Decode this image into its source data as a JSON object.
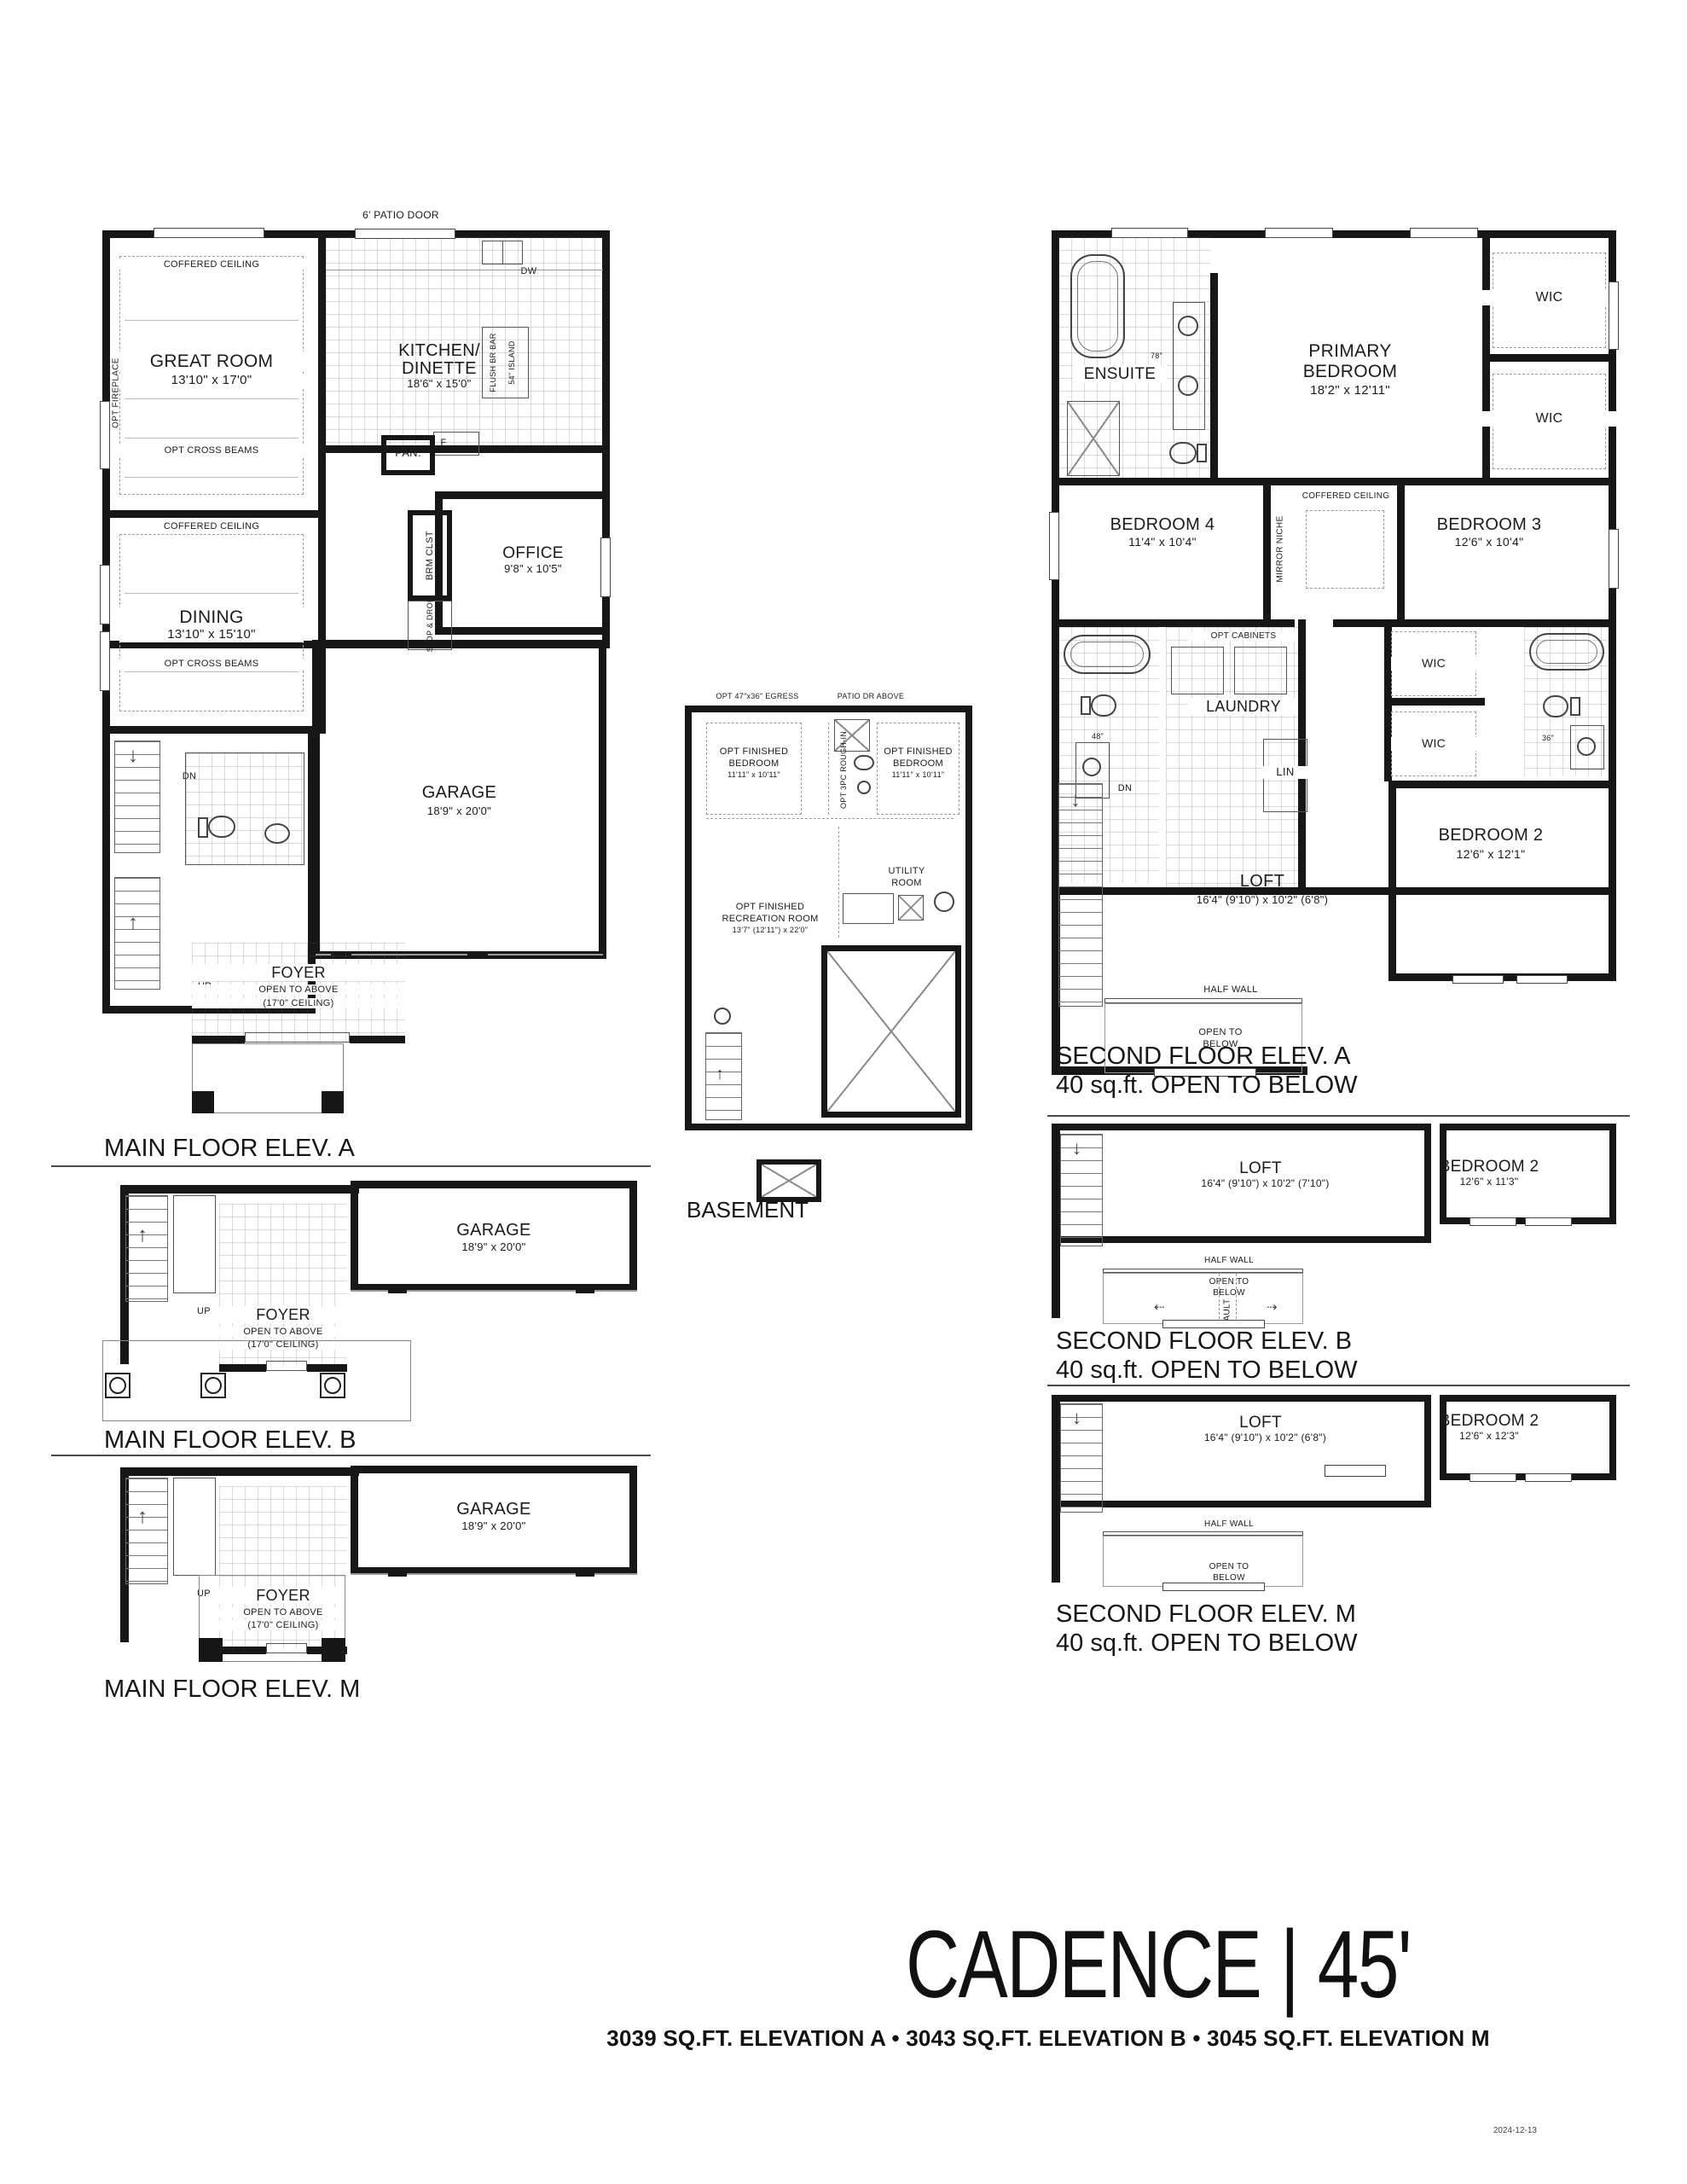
{
  "title": "CADENCE | 45'",
  "subtitle": "3039 SQ.FT. ELEVATION A • 3043 SQ.FT. ELEVATION B • 3045 SQ.FT. ELEVATION M",
  "date_stamp": "2024-12-13",
  "captions": {
    "main_a": "MAIN FLOOR ELEV. A",
    "main_b": "MAIN FLOOR ELEV. B",
    "main_m": "MAIN FLOOR ELEV. M",
    "basement": "BASEMENT",
    "second_a1": "SECOND FLOOR ELEV. A",
    "second_a2": "40 sq.ft. OPEN TO BELOW",
    "second_b1": "SECOND FLOOR ELEV. B",
    "second_b2": "40 sq.ft. OPEN TO BELOW",
    "second_m1": "SECOND FLOOR ELEV. M",
    "second_m2": "40 sq.ft. OPEN TO BELOW"
  },
  "main_floor": {
    "patio_door": "6' PATIO DOOR",
    "coffered": "COFFERED CEILING",
    "opt_cross": "OPT CROSS BEAMS",
    "opt_fireplace": "OPT FIREPLACE",
    "great_name": "GREAT ROOM",
    "great_dims": "13'10\" x 17'0\"",
    "kitchen_name1": "KITCHEN/",
    "kitchen_name2": "DINETTE",
    "kitchen_dims": "18'6\" x 15'0\"",
    "dw": "DW",
    "flush_bar": "FLUSH BR BAR",
    "island54": "54\" ISLAND",
    "fridge": "F",
    "pantry": "PAN.",
    "dining_name": "DINING",
    "dining_dims": "13'10\" x 15'10\"",
    "office_name": "OFFICE",
    "office_dims": "9'8\" x 10'5\"",
    "brm_clst": "BRM CLST",
    "stop_drop": "STOP & DROP",
    "garage_name": "GARAGE",
    "garage_dims": "18'9\" x 20'0\"",
    "foyer_name": "FOYER",
    "foyer_open": "OPEN TO ABOVE",
    "foyer_ceiling": "(17'0\" CEILING)",
    "dn": "DN",
    "up": "UP"
  },
  "basement": {
    "egress": "OPT 47\"x36\" EGRESS",
    "patio_dr": "PATIO DR ABOVE",
    "bedroom": {
      "line1": "OPT FINISHED",
      "line2": "BEDROOM",
      "dims": "11'11\" x 10'11\""
    },
    "rough_in": "OPT 3PC ROUGH-IN",
    "utility1": "UTILITY",
    "utility2": "ROOM",
    "rec1": "OPT FINISHED",
    "rec2": "RECREATION ROOM",
    "rec_dims": "13'7\" (12'11\") x 22'0\"",
    "up": "UP",
    "caption": "BASEMENT"
  },
  "second_a": {
    "ensuite": "ENSUITE",
    "v78": "78\"",
    "primary1": "PRIMARY",
    "primary2": "BEDROOM",
    "primary_dims": "18'2\" x 12'11\"",
    "wic": "WIC",
    "coffered": "COFFERED CEILING",
    "mirror": "MIRROR NICHE",
    "bed4_name": "BEDROOM 4",
    "bed4_dims": "11'4\" x 10'4\"",
    "bed3_name": "BEDROOM 3",
    "bed3_dims": "12'6\" x 10'4\"",
    "opt_cab": "OPT CABINETS",
    "laundry": "LAUNDRY",
    "lin": "LIN",
    "v48": "48\"",
    "v36": "36\"",
    "bed2_name": "BEDROOM 2",
    "bed2_dims": "12'6\" x 12'1\"",
    "loft_name": "LOFT",
    "loft_dims": "16'4\" (9'10\") x 10'2\" (6'8\")",
    "half_wall": "HALF WALL",
    "open1": "OPEN TO",
    "open2": "BELOW",
    "dn": "DN"
  },
  "second_b": {
    "loft_name": "LOFT",
    "loft_dims": "16'4\" (9'10\") x 10'2\" (7'10\")",
    "bed2_name": "BEDROOM 2",
    "bed2_dims": "12'6\" x 11'3\"",
    "half_wall": "HALF WALL",
    "open1": "OPEN TO",
    "open2": "BELOW",
    "vault": "VAULT"
  },
  "second_m": {
    "loft_name": "LOFT",
    "loft_dims": "16'4\" (9'10\") x 10'2\" (6'8\")",
    "bed2_name": "BEDROOM 2",
    "bed2_dims": "12'6\" x 12'3\"",
    "half_wall": "HALF WALL",
    "open1": "OPEN TO",
    "open2": "BELOW"
  },
  "main_b": {
    "garage_name": "GARAGE",
    "garage_dims": "18'9\" x 20'0\"",
    "foyer_name": "FOYER",
    "foyer_open": "OPEN TO ABOVE",
    "foyer_ceiling": "(17'0\" CEILING)",
    "up": "UP"
  },
  "main_m": {
    "garage_name": "GARAGE",
    "garage_dims": "18'9\" x 20'0\"",
    "foyer_name": "FOYER",
    "foyer_open": "OPEN TO ABOVE",
    "foyer_ceiling": "(17'0\" CEILING)",
    "up": "UP"
  }
}
